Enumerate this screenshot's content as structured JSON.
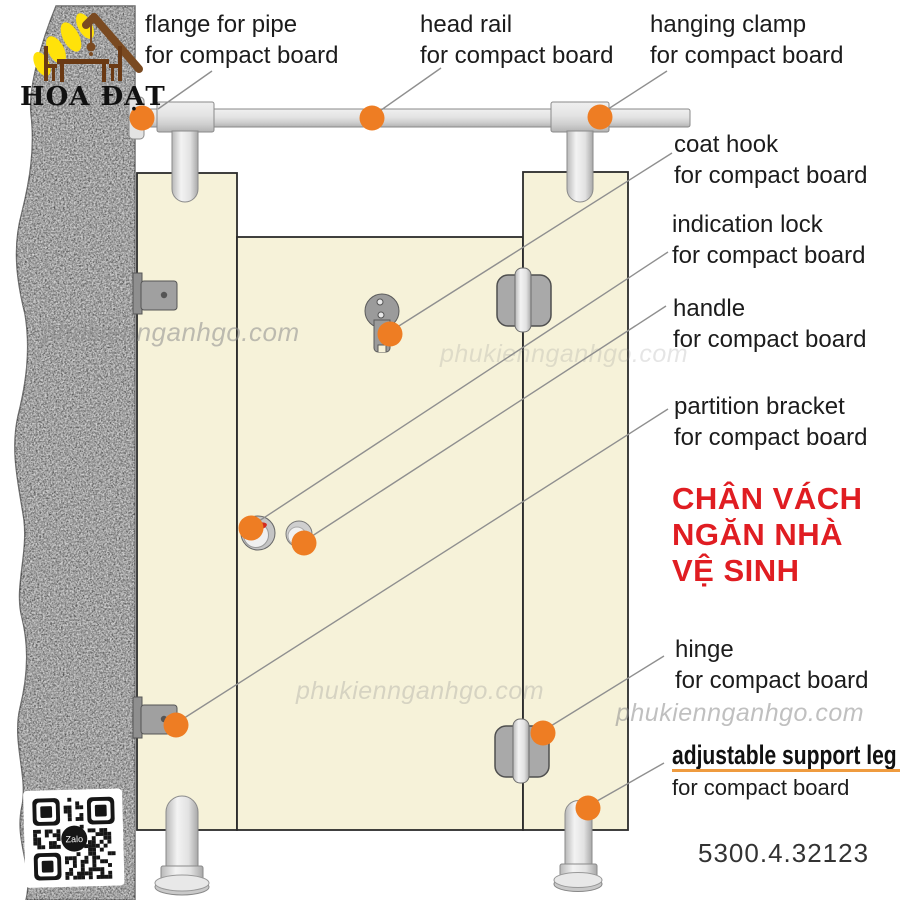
{
  "brand": {
    "logo_text": "HOA ĐẠT"
  },
  "watermark_text": "phukiennganhgo.com",
  "qr_badge": "Zalo",
  "product_code": "5300.4.32123",
  "heading": {
    "lines": [
      "CHÂN VÁCH",
      "NGĂN NHÀ",
      "VỆ SINH"
    ],
    "color": "#e01d22"
  },
  "callouts": {
    "flange": {
      "title": "flange for pipe",
      "subtitle": "for compact board"
    },
    "head_rail": {
      "title": "head rail",
      "subtitle": "for compact board"
    },
    "hanging_clamp": {
      "title": "hanging clamp",
      "subtitle": "for compact board"
    },
    "coat_hook": {
      "title": "coat hook",
      "subtitle": "for compact board"
    },
    "indication_lock": {
      "title": "indication lock",
      "subtitle": "for compact board"
    },
    "handle": {
      "title": "handle",
      "subtitle": "for compact board"
    },
    "partition_bracket": {
      "title": "partition bracket",
      "subtitle": "for compact board"
    },
    "hinge": {
      "title": "hinge",
      "subtitle": "for compact board"
    },
    "support_leg": {
      "title": "adjustable support leg",
      "subtitle": "for compact board"
    }
  },
  "colors": {
    "panel": "#f6f2d9",
    "wall": "#b9b9b9",
    "marker": "#ee7d23",
    "leader": "#8f8f8f",
    "underline": "#ef9b3f",
    "heading_red": "#e01d22"
  }
}
